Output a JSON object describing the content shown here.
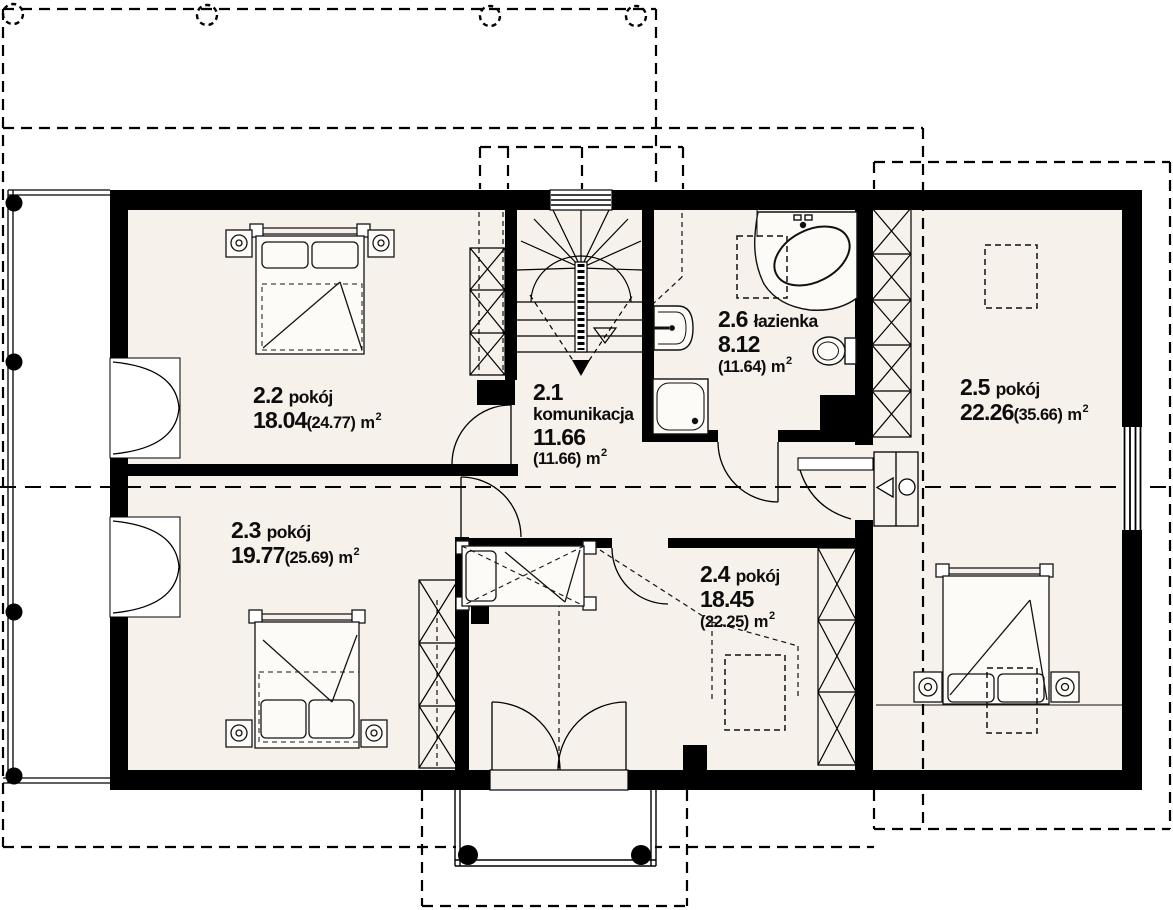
{
  "plan": {
    "type": "architectural-floor-plan",
    "floor": "poddasze",
    "unit": {
      "symbol": "m",
      "exponent": "2"
    },
    "colors": {
      "floor": "#f6f1ea",
      "wall": "#000000",
      "line": "#111111"
    },
    "rooms": {
      "r21": {
        "number": "2.1",
        "name": "komunikacja",
        "area": "11.66",
        "total": "(11.66)"
      },
      "r22": {
        "number": "2.2",
        "name": "pokój",
        "area": "18.04",
        "total": "(24.77)"
      },
      "r23": {
        "number": "2.3",
        "name": "pokój",
        "area": "19.77",
        "total": "(25.69)"
      },
      "r24": {
        "number": "2.4",
        "name": "pokój",
        "area": "18.45",
        "total": "(22.25)"
      },
      "r25": {
        "number": "2.5",
        "name": "pokój",
        "area": "22.26",
        "total": "(35.66)"
      },
      "r26": {
        "number": "2.6",
        "name": "łazienka",
        "area": "8.12",
        "total": "(11.64)"
      }
    },
    "features": [
      "staircase-winder",
      "corner-bathtub",
      "shower",
      "toilet",
      "washbasin",
      "wardrobes",
      "double-beds",
      "single-bed",
      "balcony-left",
      "balcony-bottom",
      "roof-outline-dashed",
      "section-line",
      "skylights"
    ]
  }
}
